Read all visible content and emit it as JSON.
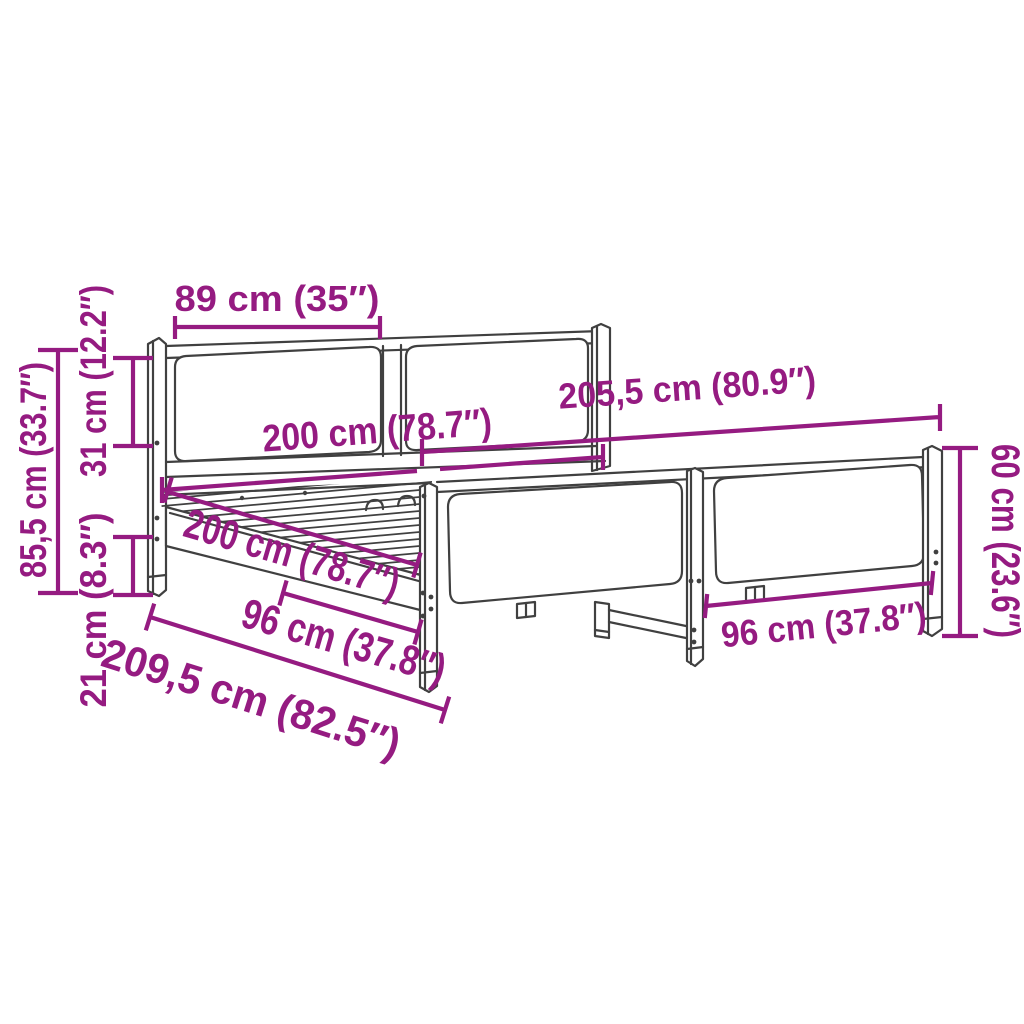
{
  "diagram": {
    "title": "Bed frame dimension diagram",
    "colors": {
      "dimension_color": "#951B81",
      "line_art_color": "#404040",
      "background": "#ffffff"
    },
    "labels": {
      "headboard_panel_width": "89 cm (35″)",
      "frame_length_total": "205,5 cm (80.9″)",
      "mattress_length": "200 cm (78.7″)",
      "mattress_width": "200 cm (78.7″)",
      "frame_width_total": "209,5 cm (82.5″)",
      "footboard_panel_width_left": "96 cm (37.8″)",
      "footboard_panel_width_right": "96 cm (37.8″)",
      "headboard_height": "85,5 cm (33.7″)",
      "headboard_panel_height": "31 cm (12.2″)",
      "under_bed_clearance": "21 cm (8.3″)",
      "footboard_height": "60 cm (23.6″)"
    }
  }
}
